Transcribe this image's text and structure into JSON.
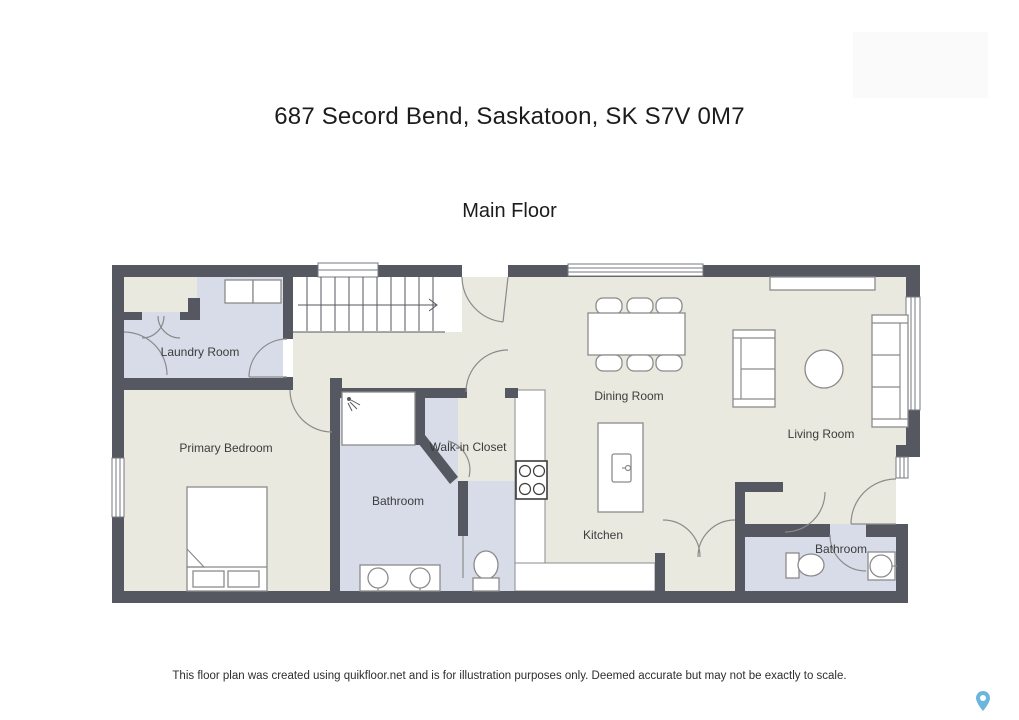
{
  "header": {
    "address_title": "687 Secord Bend, Saskatoon, SK S7V 0M7",
    "floor_title": "Main Floor"
  },
  "rooms": {
    "laundry": "Laundry Room",
    "primary_bedroom": "Primary Bedroom",
    "walk_in_closet": "Walk-in Closet",
    "bathroom_primary": "Bathroom",
    "dining": "Dining Room",
    "kitchen": "Kitchen",
    "living": "Living Room",
    "bathroom_second": "Bathroom"
  },
  "footer": {
    "disclaimer": "This floor plan was created using quikfloor.net and is for illustration purposes only. Deemed accurate but may not be exactly to scale."
  },
  "icons": {
    "map_pin": "map-pin-icon",
    "stair_arrow": "stair-direction-right-arrow"
  },
  "colors": {
    "wall": "#555761",
    "floor": "#e9e9e0",
    "wet_room_floor": "#d7dce8",
    "map_pin": "#6cb5dc",
    "furniture_outline": "#8b8b8b"
  }
}
